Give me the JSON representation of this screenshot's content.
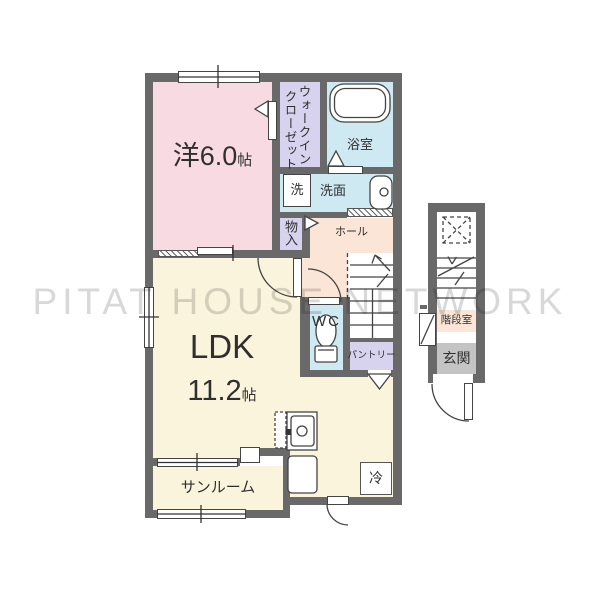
{
  "watermark": "PITAT HOUSE NETWORK",
  "rooms": {
    "western": {
      "label": "洋6.0",
      "unit": "帖"
    },
    "wic_line1": "ウォークイン",
    "wic_line2": "クローゼット",
    "bath": "浴室",
    "laundry": "洗",
    "washstand": "洗面",
    "storage": "物入",
    "hall": "ホール",
    "wc": "WC",
    "pantry": "パントリー",
    "ldk_label": "LDK",
    "ldk_size": "11.2",
    "ldk_unit": "帖",
    "sunroom": "サンルーム",
    "fridge": "冷",
    "stair_room": "階段室",
    "entrance": "玄関"
  },
  "colors": {
    "wall": "#696969",
    "western_room": "#f8dbe2",
    "closet": "#d7d3ee",
    "wet_area": "#cfe9f3",
    "hall_floor": "#fae5d6",
    "living_floor": "#faf4dc",
    "entrance_floor": "#c4c4c5",
    "watermark": "#d5d5d5"
  }
}
